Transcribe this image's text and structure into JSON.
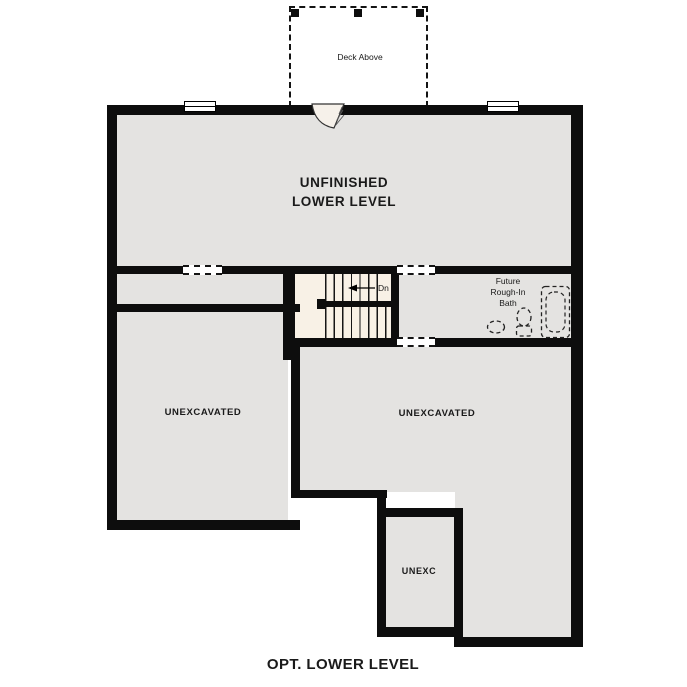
{
  "plan_title": "OPT. LOWER LEVEL",
  "labels": {
    "deck": "Deck Above",
    "main_room_line1": "UNFINISHED",
    "main_room_line2": "LOWER LEVEL",
    "left_room": "UNEXCAVATED",
    "right_room": "UNEXCAVATED",
    "small_room": "UNEXC",
    "bath_line1": "Future",
    "bath_line2": "Rough-In",
    "bath_line3": "Bath",
    "stair_direction": "Dn"
  },
  "colors": {
    "wall": "#0d0d0d",
    "floor": "#e4e3e1",
    "stairs": "#f8f1e6",
    "ink": "#1a1a1a",
    "bg": "#ffffff"
  }
}
